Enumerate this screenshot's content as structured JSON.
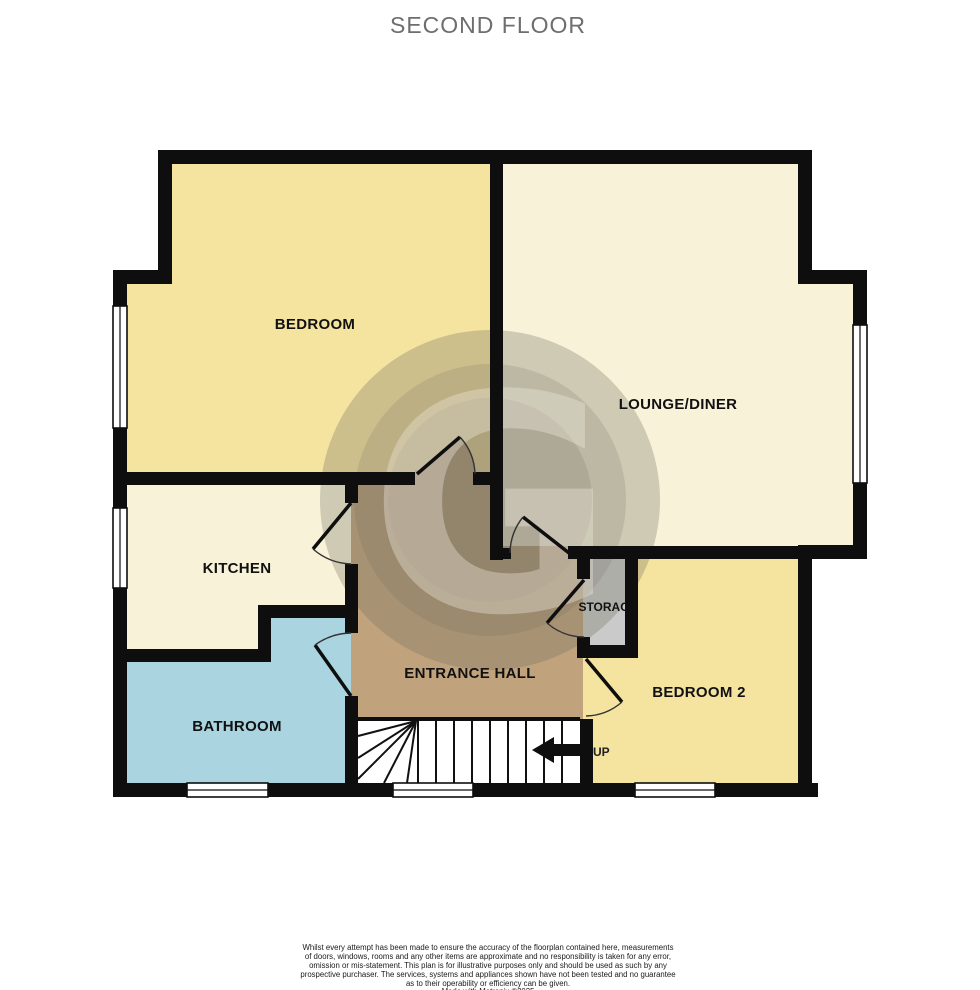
{
  "title": "SECOND FLOOR",
  "floorplan": {
    "rooms": {
      "bedroom": {
        "label": "BEDROOM"
      },
      "lounge_diner": {
        "label": "LOUNGE/DINER"
      },
      "kitchen": {
        "label": "KITCHEN"
      },
      "bathroom": {
        "label": "BATHROOM"
      },
      "entrance_hall": {
        "label": "ENTRANCE HALL"
      },
      "storage": {
        "label": "STORAGE"
      },
      "bedroom_2": {
        "label": "BEDROOM 2"
      }
    },
    "stairs": {
      "label": "UP"
    },
    "watermark": {
      "letter": "G"
    },
    "colors": {
      "bedroom": "#F5E3A0",
      "lounge_diner": "#F8F2D8",
      "kitchen": "#F8F2D8",
      "bathroom": "#A9D4E0",
      "entrance_hall": "#C0A27D",
      "storage": "#CACACA",
      "bedroom_2": "#F5E3A0",
      "stairs": "#FFFFFF",
      "wall": "#0E0E0E"
    }
  },
  "disclaimer": {
    "lines": [
      "Whilst every attempt has been made to ensure the accuracy of the floorplan contained here, measurements",
      "of doors, windows, rooms and any other items are approximate and no responsibility is taken for any error,",
      "omission or mis-statement. This plan is for illustrative purposes only and should be used as such by any",
      "prospective purchaser. The services, systems and appliances shown have not been tested and no guarantee",
      "as to their operability or efficiency can be given.",
      "Made with Metropix ©2025"
    ]
  }
}
